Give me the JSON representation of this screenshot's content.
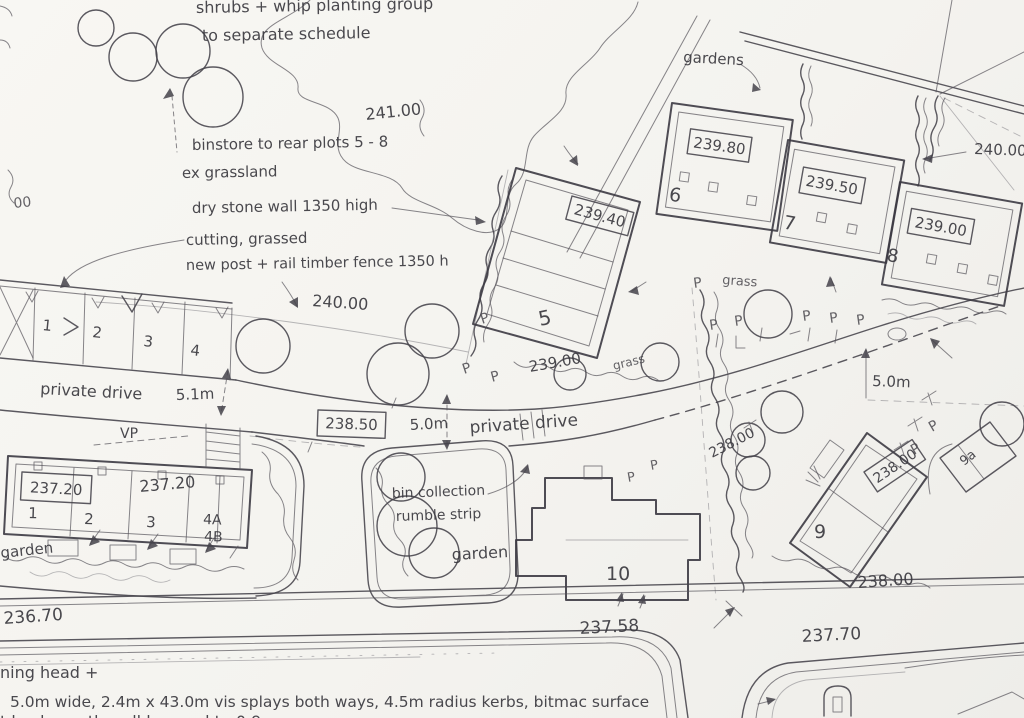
{
  "notes": {
    "planting_line1": "shrubs + whip planting group",
    "planting_line2": "to separate schedule",
    "binstore": "binstore to rear plots 5 - 8",
    "ex_grassland": "ex grassland",
    "dry_stone_wall": "dry stone wall 1350 high",
    "cutting_grassed": "cutting, grassed",
    "post_rail_fence": "new post + rail timber fence 1350 h",
    "gardens": "gardens",
    "grass": "grass",
    "garden": "garden",
    "private_drive": "private drive",
    "bin_line1": "bin collection",
    "bin_line2": "rumble strip",
    "vp": "VP",
    "p_marker": "P",
    "turning_head_partial": "ning head +",
    "access_spec": "5.0m wide, 2.4m x 43.0m vis splays both ways, 4.5m radius kerbs, bitmac surface",
    "clipped_bottom_line": "t back, south wall lowered to 0.9",
    "clipped_left_level": "00"
  },
  "levels": {
    "v241": "241.00",
    "v240_left": "240.00",
    "v240_right": "240.00",
    "v239_80": "239.80",
    "v239_50": "239.50",
    "v239_40": "239.40",
    "v239_00_box": "239.00",
    "v239_00_ground": "239.00",
    "v238_50": "238.50",
    "v238_00_hand": "238.00",
    "v238_00_box": "238.00",
    "v238_00_road": "238.00",
    "v237_20_box": "237.20",
    "v237_20_hand": "237.20",
    "v237_58": "237.58",
    "v237_70": "237.70",
    "v236_70": "236.70"
  },
  "dimensions": {
    "left_drive": "5.1m",
    "centre_drive": "5.0m",
    "right_drive": "5.0m"
  },
  "plots": {
    "n5": "5",
    "n6": "6",
    "n7": "7",
    "n8": "8",
    "n9": "9",
    "n9a": "9a",
    "n10": "10",
    "u1": "1",
    "u2": "2",
    "u3": "3",
    "u4a": "4A",
    "u4b": "4B"
  },
  "parking_bays": [
    "1",
    "2",
    "3",
    "4"
  ]
}
